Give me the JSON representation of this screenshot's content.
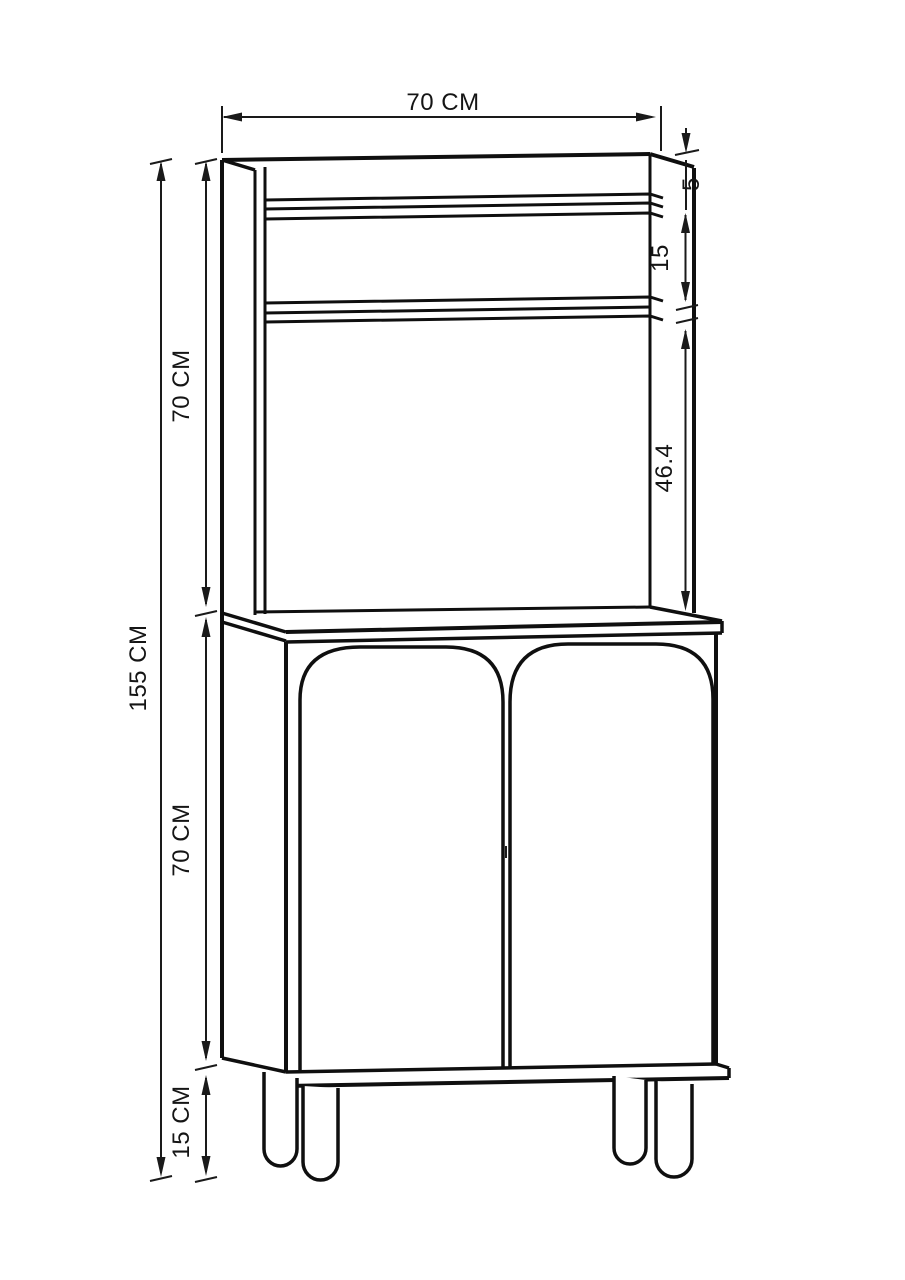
{
  "page": {
    "background": "#ffffff",
    "line_color": "#0f0f0f",
    "dimension_color": "#1a1a1a"
  },
  "dimensions": {
    "top_width": "70 CM",
    "top_panel_thickness": "5",
    "shelf_spacing": "15",
    "shelf_to_counter": "46.4",
    "total_height": "155 CM",
    "upper_section_height": "70 CM",
    "lower_section_height": "70 CM",
    "legs_height": "15 CM"
  }
}
